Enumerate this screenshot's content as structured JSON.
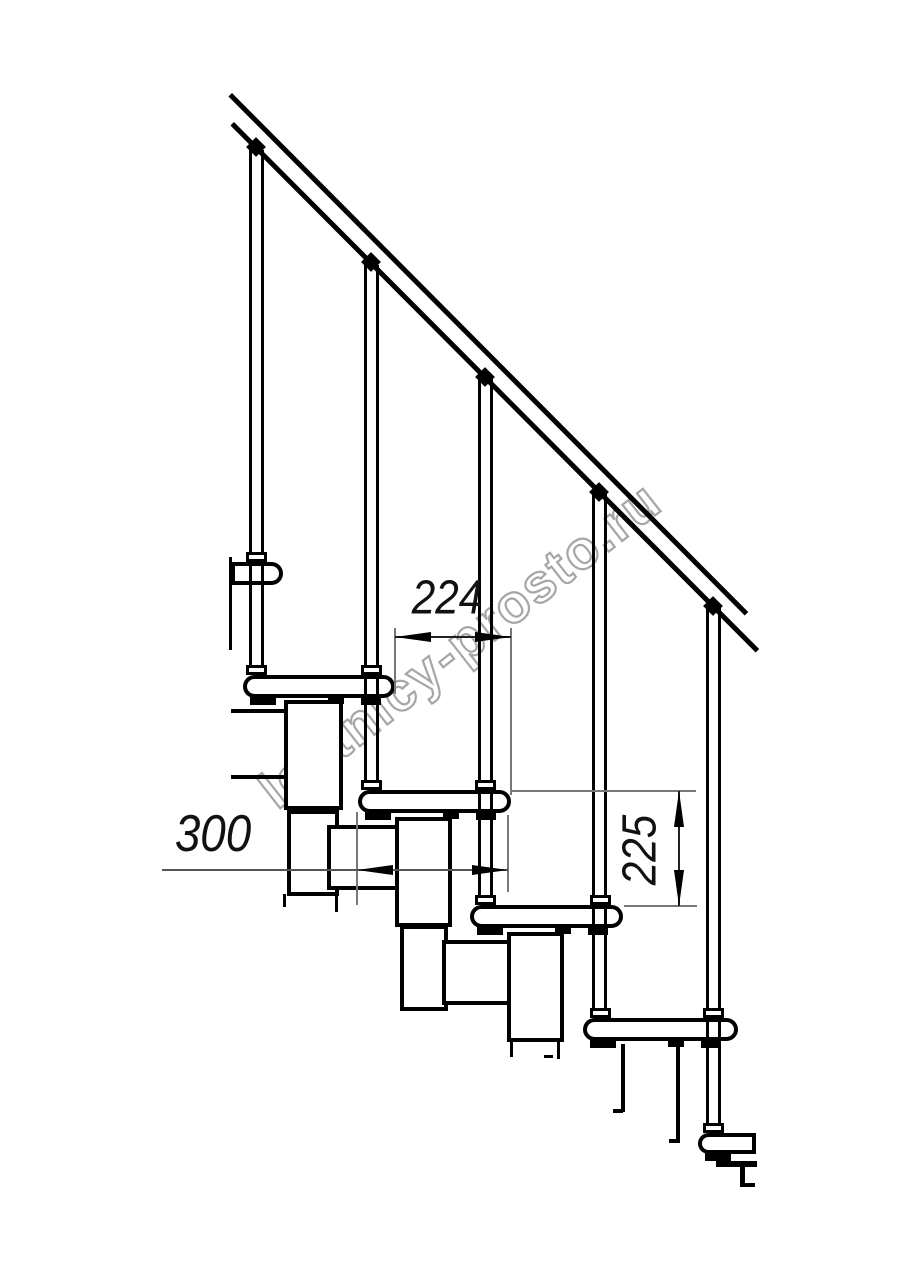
{
  "drawing": {
    "title": "modular-staircase-side-view",
    "dimensions": {
      "going": {
        "value": "224"
      },
      "tread_depth": {
        "value": "300"
      },
      "rise": {
        "value": "225"
      }
    },
    "watermark": {
      "text": "lestnicy-prosto.ru",
      "color": "#a6a6a6"
    },
    "colors": {
      "line": "#000000",
      "dimension_line": "#777777",
      "background": "#ffffff"
    }
  }
}
